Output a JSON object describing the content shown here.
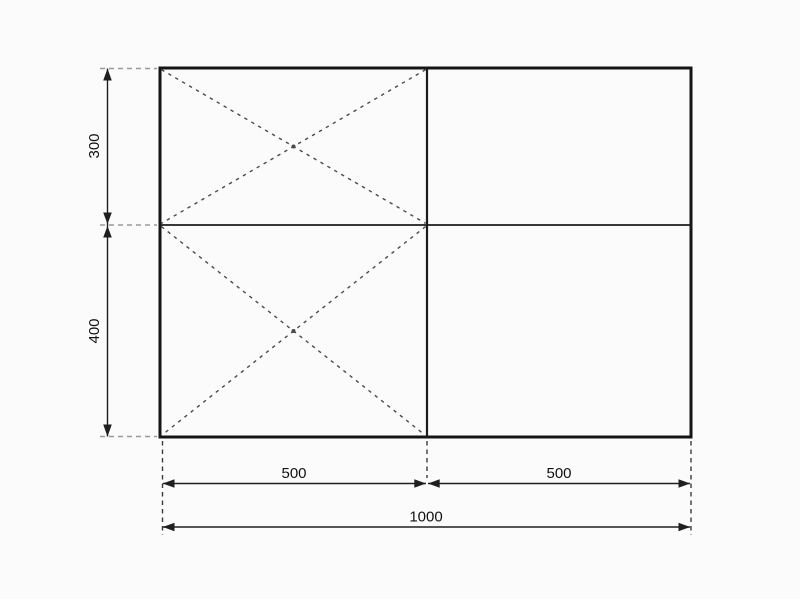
{
  "drawing": {
    "description": "Dimensioned rectangular plan: 1000 wide, split 500 + 500 horizontally and 300 + 400 vertically, with dashed diagonal cross-bracing in the two left cells",
    "dimensions": {
      "left_top_height": "300",
      "left_bottom_height": "400",
      "bottom_left_width": "500",
      "bottom_right_width": "500",
      "bottom_total_width": "1000"
    }
  },
  "colors": {
    "background": "#fbfbfb",
    "outline": "#151515",
    "divider": "#1c1c1c",
    "diagonal": "#4a4a4a",
    "dimension": "#1f1f1f",
    "extension_gray": "#9a9a9a",
    "extension_dark": "#3a3a3a",
    "text": "#111111"
  }
}
